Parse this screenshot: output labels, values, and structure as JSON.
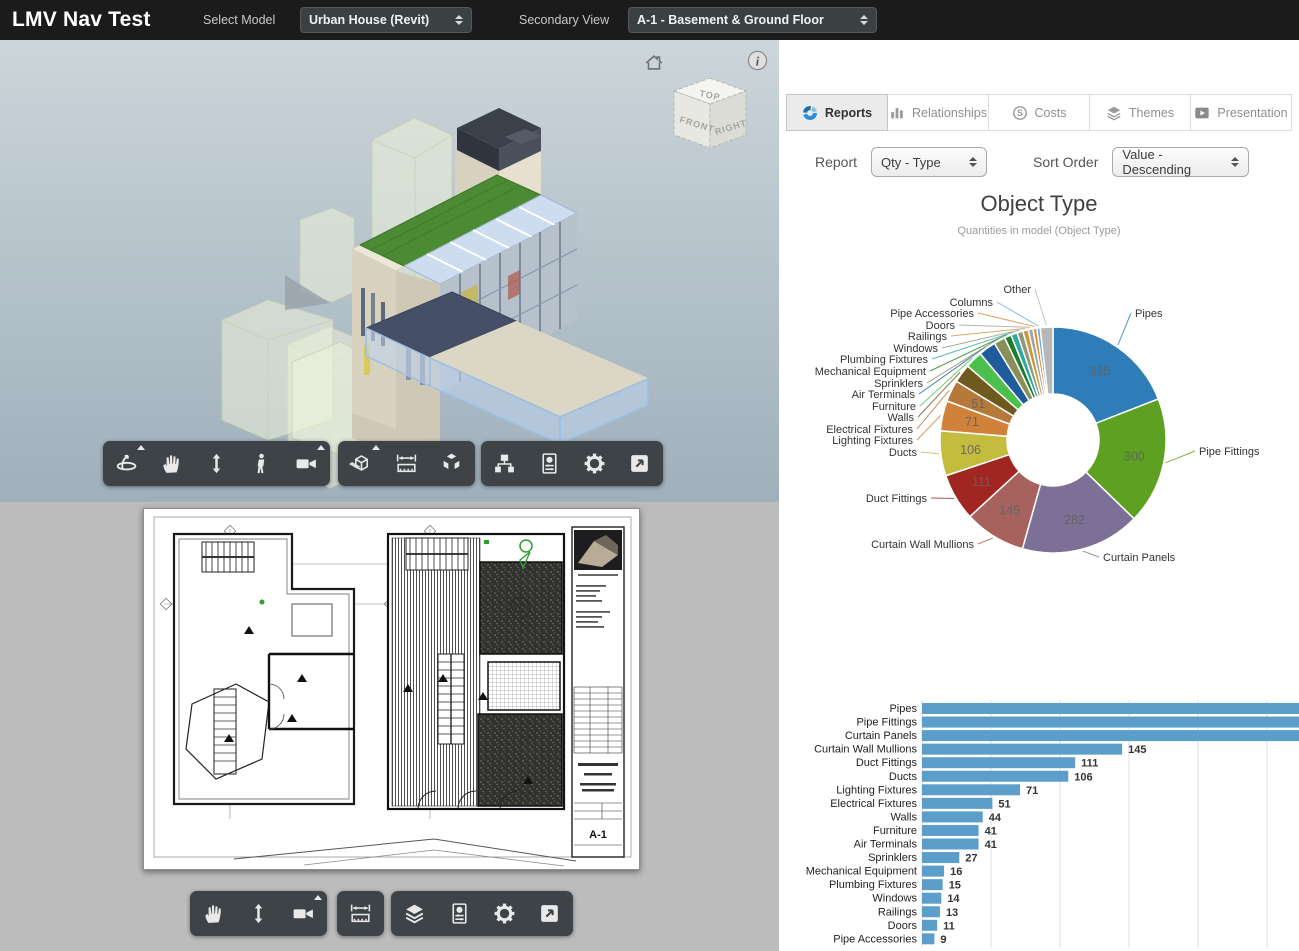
{
  "header": {
    "title": "LMV Nav Test",
    "select_model_label": "Select Model",
    "select_model_value": "Urban House (Revit)",
    "secondary_view_label": "Secondary View",
    "secondary_view_value": "A-1 - Basement & Ground Floor"
  },
  "tabs": [
    {
      "label": "Reports",
      "icon": "reports-donut-icon",
      "active": true
    },
    {
      "label": "Relationships",
      "icon": "bar-chart-icon",
      "active": false
    },
    {
      "label": "Costs",
      "icon": "dollar-circle-icon",
      "active": false
    },
    {
      "label": "Themes",
      "icon": "layers-icon",
      "active": false
    },
    {
      "label": "Presentation",
      "icon": "play-icon",
      "active": false
    }
  ],
  "controls": {
    "report_label": "Report",
    "report_value": "Qty - Type",
    "sort_label": "Sort Order",
    "sort_value": "Value - Descending"
  },
  "chart_data": [
    {
      "type": "pie",
      "variant": "donut",
      "title": "Object Type",
      "subtitle": "Quantities in model (Object Type)",
      "categories": [
        "Pipes",
        "Pipe Fittings",
        "Curtain Panels",
        "Curtain Wall Mullions",
        "Duct Fittings",
        "Ducts",
        "Lighting Fixtures",
        "Electrical Fixtures",
        "Walls",
        "Furniture",
        "Air Terminals",
        "Sprinklers",
        "Mechanical Equipment",
        "Plumbing Fixtures",
        "Windows",
        "Railings",
        "Doors",
        "Pipe Accessories",
        "Columns",
        "Other"
      ],
      "values": [
        315,
        300,
        282,
        145,
        111,
        106,
        71,
        51,
        44,
        41,
        41,
        27,
        16,
        15,
        14,
        13,
        11,
        9,
        8,
        30
      ],
      "colors": [
        "#2e7cb8",
        "#5ea021",
        "#7d7097",
        "#a8625d",
        "#a12622",
        "#c3bc3f",
        "#d0813a",
        "#b5793a",
        "#6e5a1e",
        "#4cbf4c",
        "#1e5c9e",
        "#8a8f5a",
        "#1e7d2c",
        "#2fa8a0",
        "#8d9878",
        "#c89a3e",
        "#a2a2a2",
        "#d88f35",
        "#6fa8dc",
        "#b8b8b8"
      ],
      "inner_value_labels": [
        315,
        300,
        282,
        145,
        111,
        106,
        71,
        51
      ]
    },
    {
      "type": "bar",
      "orientation": "horizontal",
      "categories": [
        "Pipes",
        "Pipe Fittings",
        "Curtain Panels",
        "Curtain Wall Mullions",
        "Duct Fittings",
        "Ducts",
        "Lighting Fixtures",
        "Electrical Fixtures",
        "Walls",
        "Furniture",
        "Air Terminals",
        "Sprinklers",
        "Mechanical Equipment",
        "Plumbing Fixtures",
        "Windows",
        "Railings",
        "Doors",
        "Pipe Accessories"
      ],
      "values": [
        315,
        300,
        282,
        145,
        111,
        106,
        71,
        51,
        44,
        41,
        41,
        27,
        16,
        15,
        14,
        13,
        11,
        9
      ],
      "bar_color": "#5b9ec9",
      "xlim": [
        0,
        273
      ],
      "gridlines": [
        0,
        50,
        100,
        150,
        200,
        250
      ],
      "grid": true,
      "note_visible_value_labels": [
        145,
        111,
        106,
        71,
        51,
        44,
        41,
        41,
        27,
        16,
        15,
        14,
        13,
        11,
        9
      ]
    }
  ],
  "viewer3d": {
    "viewcube": {
      "top": "TOP",
      "front": "FRONT",
      "right": "RIGHT"
    },
    "toolbar_icons": [
      "orbit",
      "pan-hand",
      "zoom-updown",
      "first-person",
      "camera",
      "section-box",
      "measure",
      "explode",
      "model-tree",
      "properties",
      "settings",
      "fullscreen"
    ],
    "corner_icons": [
      "home",
      "info"
    ]
  },
  "viewer2d": {
    "sheet_number": "A-1",
    "toolbar_icons": [
      "pan-hand",
      "zoom-updown",
      "camera",
      "measure",
      "layers",
      "properties",
      "settings",
      "fullscreen"
    ]
  }
}
